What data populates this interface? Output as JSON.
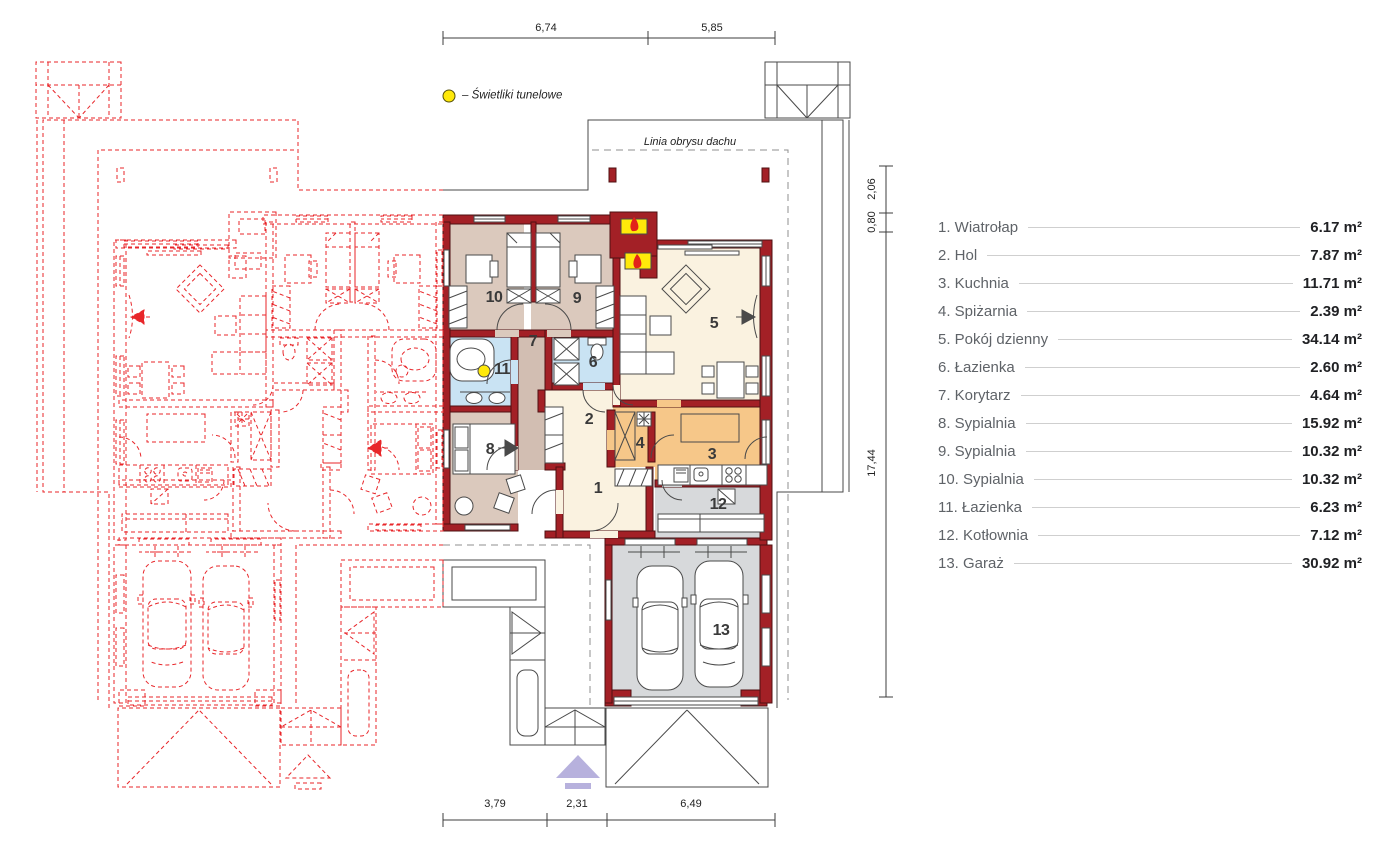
{
  "legend": {
    "label": "– Świetliki tunelowe"
  },
  "roof_outline_label": "Linia obrysu dachu",
  "dimensions": {
    "top": [
      "6,74",
      "5,85"
    ],
    "bottom": [
      "3,79",
      "2,31",
      "6,49"
    ],
    "right": [
      "2,06",
      "0,80",
      "17,44"
    ]
  },
  "rooms": [
    {
      "number": "1",
      "name": "Wiatrołap",
      "display": "1. Wiatrołap",
      "area": "6.17 m²"
    },
    {
      "number": "2",
      "name": "Hol",
      "display": "2. Hol",
      "area": "7.87 m²"
    },
    {
      "number": "3",
      "name": "Kuchnia",
      "display": "3. Kuchnia",
      "area": "11.71 m²"
    },
    {
      "number": "4",
      "name": "Spiżarnia",
      "display": "4. Spiżarnia",
      "area": "2.39 m²"
    },
    {
      "number": "5",
      "name": "Pokój dzienny",
      "display": "5. Pokój dzienny",
      "area": "34.14 m²"
    },
    {
      "number": "6",
      "name": "Łazienka",
      "display": "6. Łazienka",
      "area": "2.60 m²"
    },
    {
      "number": "7",
      "name": "Korytarz",
      "display": "7. Korytarz",
      "area": "4.64 m²"
    },
    {
      "number": "8",
      "name": "Sypialnia",
      "display": "8. Sypialnia",
      "area": "15.92 m²"
    },
    {
      "number": "9",
      "name": "Sypialnia",
      "display": "9. Sypialnia",
      "area": "10.32 m²"
    },
    {
      "number": "10",
      "name": "Sypialnia",
      "display": "10. Sypialnia",
      "area": "10.32 m²"
    },
    {
      "number": "11",
      "name": "Łazienka",
      "display": "11. Łazienka",
      "area": "6.23 m²"
    },
    {
      "number": "12",
      "name": "Kotłownia",
      "display": "12. Kotłownia",
      "area": "7.12 m²"
    },
    {
      "number": "13",
      "name": "Garaż",
      "display": "13. Garaż",
      "area": "30.92 m²"
    }
  ],
  "colors": {
    "wall": "#a32026",
    "mirror": "#e8262a",
    "bedroom": "#dbc9bd",
    "bathroom": "#c9e3f3",
    "kitchen": "#f6c789",
    "utility": "#d7d9db",
    "living": "#faf2e0",
    "skylight": "#ffe90a",
    "entrance_arrow": "#b7b1dd"
  }
}
